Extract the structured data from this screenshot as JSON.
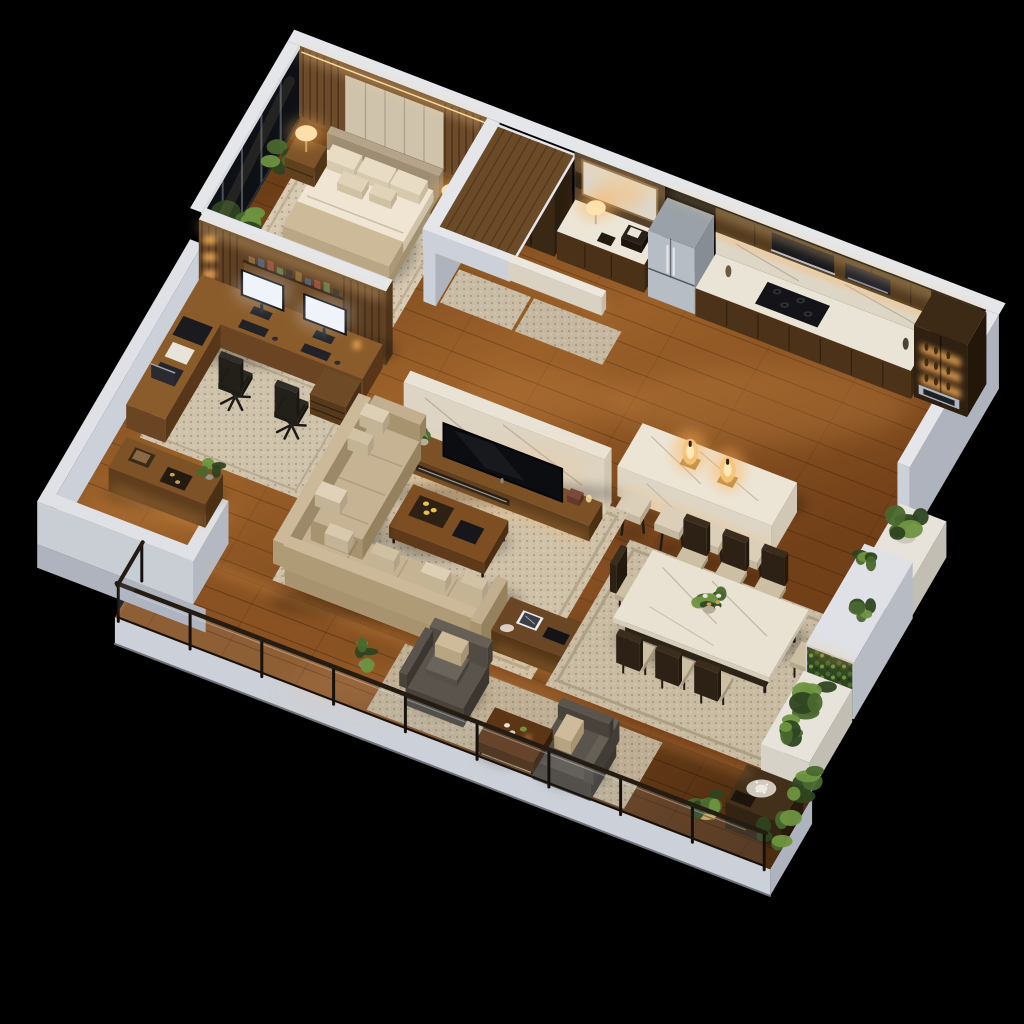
{
  "scene": {
    "title": "Isometric 3D floor plan of a luxury apartment at night with warm cove lighting",
    "type": "isometric-3d-floor-plan",
    "background": "#000000",
    "lighting": {
      "mood": "night",
      "accent": "warm LED cove and under-cabinet strips",
      "glow_color": "#ffb45c"
    },
    "palette": {
      "bg": "#000000",
      "wall_top": "#e4e6ea",
      "wall_light": "#ccd0d8",
      "wall_shadow": "#aeb3bd",
      "wood_floor": "#8a5424",
      "deck_wood": "#6e4019",
      "walnut": "#5b3c1f",
      "walnut_dark": "#3a2815",
      "walnut_light": "#7d5228",
      "marble": "#ebe4d5",
      "marble_shade": "#d9d0bd",
      "rug": "#cfc1a8",
      "rug_border": "#b3a486",
      "sofa": "#c6b394",
      "sofa_shade": "#a8936f",
      "cushion": "#dccdb0",
      "chair_wood": "#3a2d1e",
      "seat": "#cdbfa4",
      "armchair": "#5b544c",
      "stainless": "#b7bdc4",
      "tv_black": "#0b0d11",
      "screen_white": "#f4f7fb",
      "glass_night": "#0d1116",
      "glass_tint": "rgba(185,210,230,0.10)",
      "railing_metal": "#16110c",
      "glow": "#ffb45c",
      "glow_strong": "#ffd896",
      "lamp": "#ffe3b0",
      "leaf": "#49682e",
      "leaf_light": "#6e9440",
      "leaf_dark": "#2e4520",
      "gold": "#c9a24e"
    },
    "rooms": [
      {
        "name": "master-bedroom",
        "label": "Master Bedroom",
        "items": [
          "upholstered king bed",
          "two walnut nightstands",
          "lit table lamps",
          "beige area rug",
          "floor-to-ceiling window wall",
          "wood slat headboard wall"
        ]
      },
      {
        "name": "closet",
        "label": "Closet Hall",
        "items": [
          "tall walnut wardrobe",
          "wood canopy header",
          "runner rug"
        ]
      },
      {
        "name": "vanity-nook",
        "label": "Vanity Study Nook",
        "items": [
          "marble counter",
          "table lamp",
          "mirror",
          "marble header beam"
        ]
      },
      {
        "name": "kitchen",
        "label": "Kitchen",
        "items": [
          "stainless french-door refrigerator",
          "walnut cabinetry",
          "marble backsplash",
          "gas cooktop",
          "lit display cabinet",
          "wall oven",
          "marble waterfall island",
          "two amber lantern lamps",
          "four upholstered bar stools"
        ]
      },
      {
        "name": "home-office",
        "label": "Home Office",
        "items": [
          "L-shaped walnut desk",
          "two bright monitors",
          "two black office chairs",
          "laptop",
          "backlit shelving wall",
          "area rug"
        ]
      },
      {
        "name": "living-room",
        "label": "Living Room",
        "items": [
          "beige L-sectional sofa",
          "walnut coffee table with tray",
          "marble TV partition wall",
          "low walnut media console",
          "flat-screen TV",
          "large area rug",
          "side console with tablet and keyboard"
        ]
      },
      {
        "name": "dining-room",
        "label": "Dining Room",
        "items": [
          "marble dining table",
          "eight dark wood chairs",
          "floral centerpiece",
          "area rug"
        ]
      },
      {
        "name": "green-wall",
        "label": "Planters and Green Wall",
        "items": [
          "white marble planters",
          "backlit living green wall",
          "terrace console with crystal dish",
          "gold striped planter"
        ]
      },
      {
        "name": "entry-foyer",
        "label": "Entry Foyer",
        "items": [
          "walnut console with books and tray",
          "white half walls"
        ]
      },
      {
        "name": "balcony",
        "label": "Balcony Terrace",
        "items": [
          "glass and black-steel railing",
          "two gray lounge armchairs with beige pillows",
          "walnut coffee table",
          "potted plants",
          "outdoor rug"
        ]
      }
    ]
  }
}
